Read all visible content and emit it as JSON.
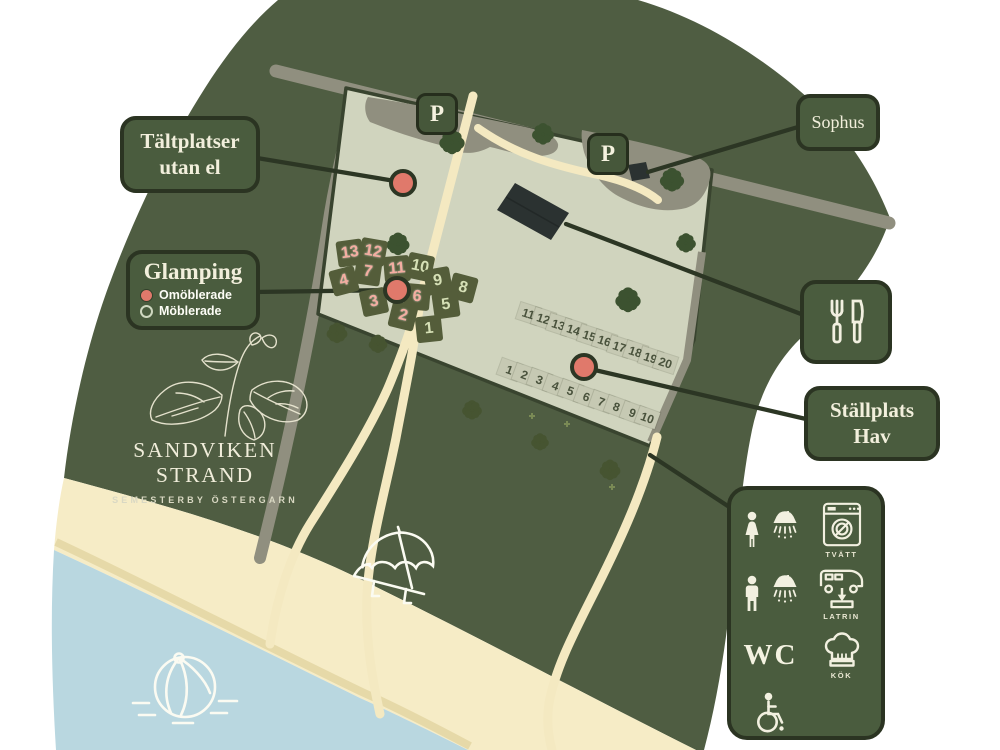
{
  "map_title": {
    "name": "SANDVIKEN STRAND",
    "subtitle": "SEMESTERBY ÖSTERGARN"
  },
  "callouts": {
    "tent_sites": {
      "line1": "Tältplatser",
      "line2": "utan el"
    },
    "glamping": {
      "title": "Glamping",
      "legend": [
        {
          "label": "Omöblerade",
          "marker": "filled-red"
        },
        {
          "label": "Möblerade",
          "marker": "outline-green"
        }
      ]
    },
    "sophus": {
      "label": "Sophus"
    },
    "restaurant": {
      "icon": "fork-and-knife"
    },
    "stallplats": {
      "line1": "Ställplats",
      "line2": "Hav"
    }
  },
  "parking": {
    "label": "P"
  },
  "glamping_tents": [
    {
      "n": "13",
      "type": "omoblerad"
    },
    {
      "n": "12",
      "type": "omoblerad"
    },
    {
      "n": "4",
      "type": "omoblerad"
    },
    {
      "n": "7",
      "type": "omoblerad"
    },
    {
      "n": "11",
      "type": "omoblerad"
    },
    {
      "n": "10",
      "type": "moblerad"
    },
    {
      "n": "9",
      "type": "moblerad"
    },
    {
      "n": "8",
      "type": "moblerad"
    },
    {
      "n": "3",
      "type": "omoblerad"
    },
    {
      "n": "6",
      "type": "omoblerad"
    },
    {
      "n": "5",
      "type": "moblerad"
    },
    {
      "n": "2",
      "type": "omoblerad"
    },
    {
      "n": "1",
      "type": "moblerad"
    }
  ],
  "pitches": {
    "upper_row": [
      "11",
      "12",
      "13",
      "14",
      "15",
      "16",
      "17",
      "18",
      "19",
      "20"
    ],
    "lower_row": [
      "1",
      "2",
      "3",
      "4",
      "5",
      "6",
      "7",
      "8",
      "9",
      "10"
    ]
  },
  "facilities": {
    "items": [
      {
        "icon": "woman-shower"
      },
      {
        "icon": "washing-machine",
        "label": "TVÄTT"
      },
      {
        "icon": "man-shower"
      },
      {
        "icon": "rv-latrine",
        "label": "LATRIN"
      },
      {
        "icon": "wc-text",
        "label": "WC"
      },
      {
        "icon": "chef-hat",
        "label": "KÖK"
      },
      {
        "icon": "wheelchair"
      }
    ]
  },
  "colors": {
    "forest": "#4f5d42",
    "field": "#d0d4be",
    "path": "#f4e9c1",
    "road": "#908f7f",
    "sea": "#b9d7e0",
    "beach": "#f6ecc6",
    "box_green": "#4a5c3e",
    "outline": "#2c3624",
    "marker_red": "#e0796b",
    "cream_text": "#f2efdc"
  }
}
